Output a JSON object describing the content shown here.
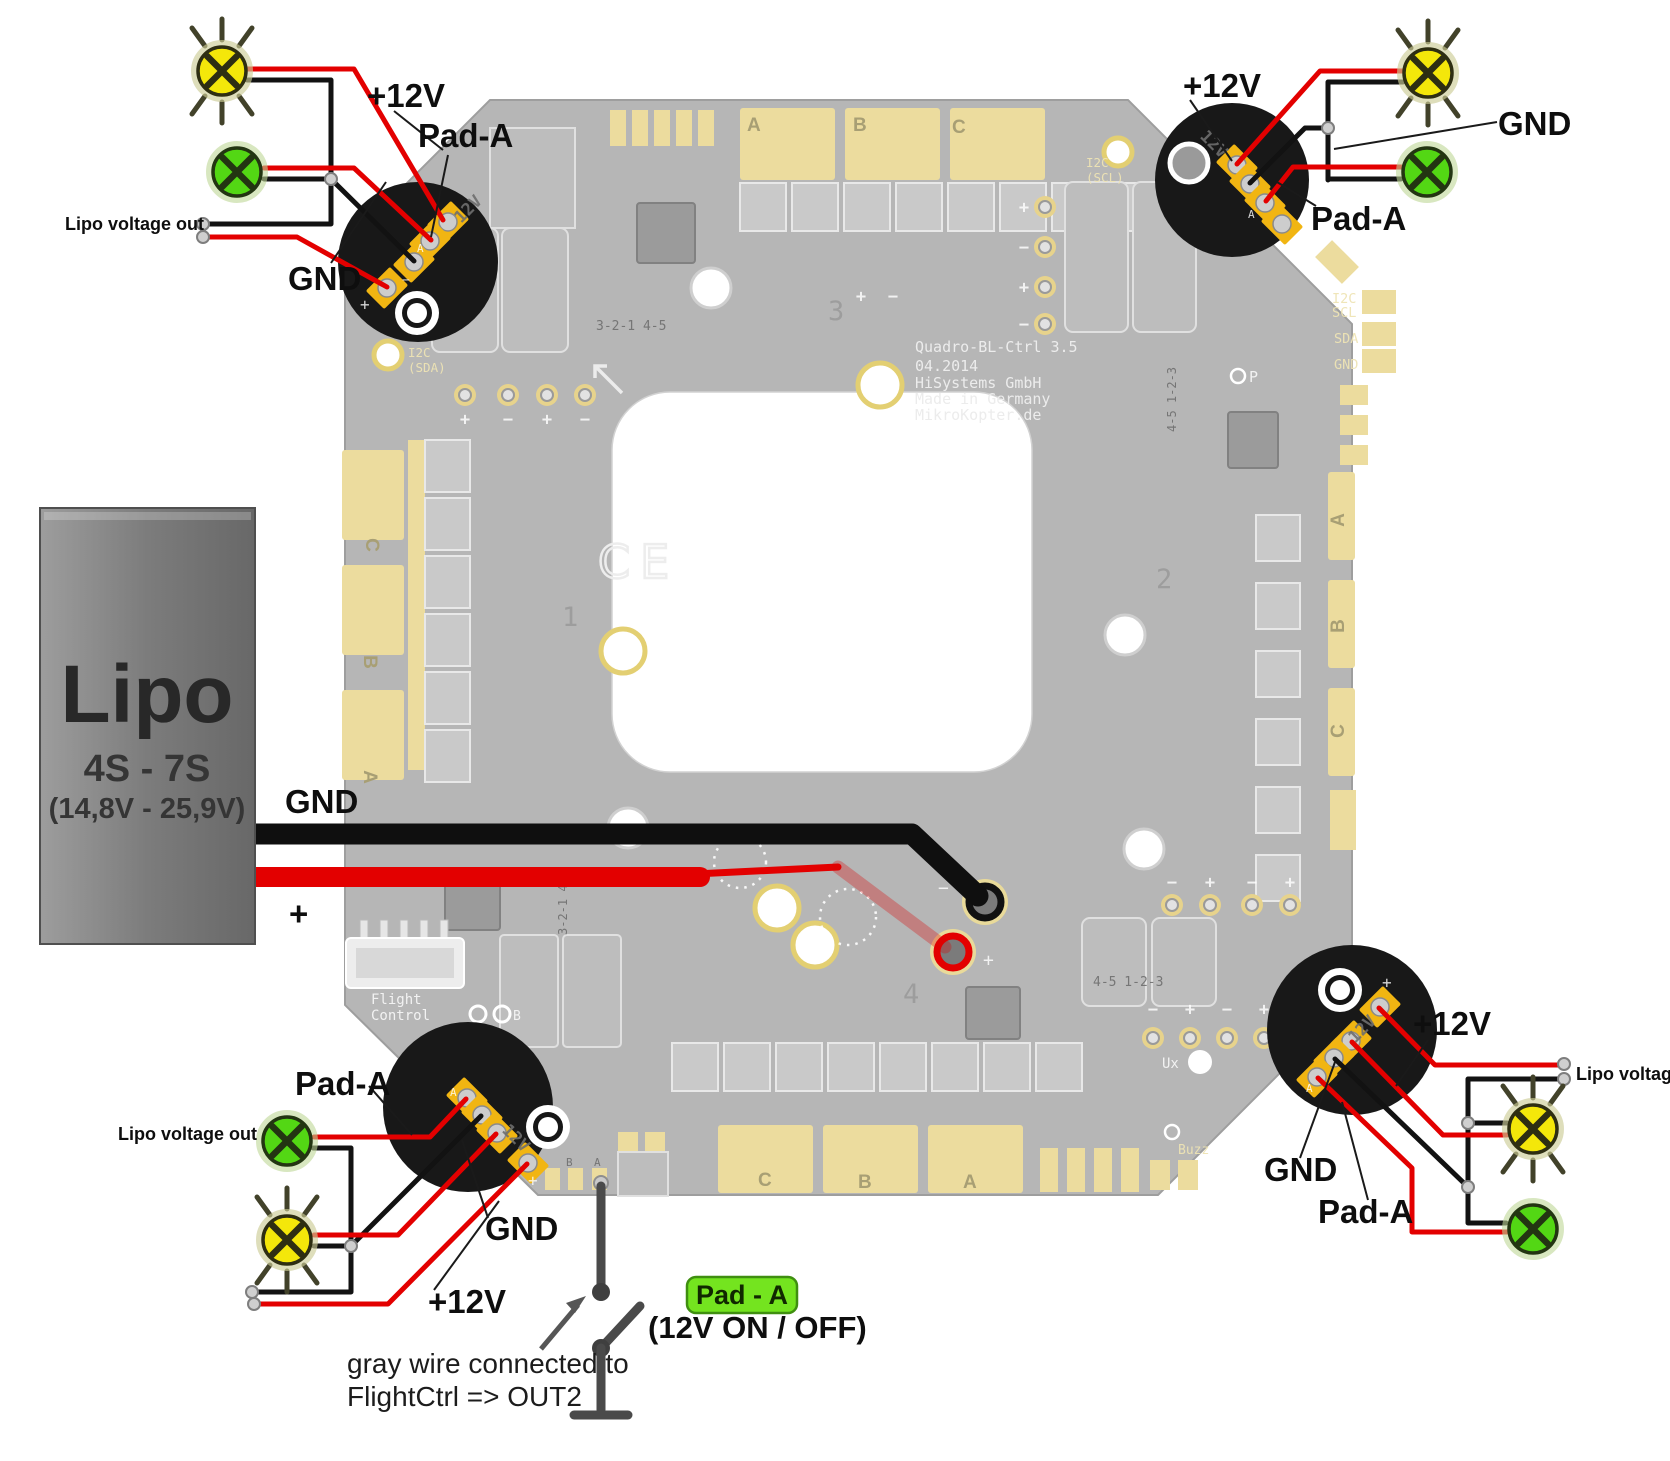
{
  "colors": {
    "wire_red": "#e30000",
    "wire_black": "#121212",
    "led_yellow": "#f4e70a",
    "led_green": "#53d714",
    "badge_green": "#74e41f",
    "board_gray": "#b6b6b6",
    "pad_yellow": "#ecdc9e",
    "module_pad_yellow": "#f1b512"
  },
  "board": {
    "title": "Quadro-BL-Ctrl 3.5",
    "version_date": "04.2014",
    "manufacturer": "HiSystems GmbH",
    "made_in": "Made in Germany",
    "website": "MikroKopter.de",
    "ce_mark": "CE",
    "i2c_label": "I2C",
    "scl_label": "SCL",
    "sda_label": "SDA",
    "gnd_label": "GND",
    "scl_paren": "(SCL)",
    "sda_paren": "(SDA)",
    "motor_1": "1",
    "motor_2": "2",
    "motor_3": "3",
    "motor_4": "4",
    "conn_row_1": "3-2-1 4-5",
    "conn_row_2": "4-5 1-2-3",
    "flight_label": "Flight",
    "control_label": "Control",
    "buzz_label": "Buzz",
    "ux_label": "Ux",
    "p_label": "P",
    "b_label": "B",
    "a_label": "A",
    "module_12v": "12V",
    "plus_mark": "+",
    "minus_mark": "−",
    "phase_top": [
      "A",
      "B",
      "C"
    ],
    "phase_bottom": [
      "C",
      "B",
      "A"
    ],
    "phase_left": [
      "C",
      "B",
      "A"
    ],
    "phase_right": [
      "A",
      "B",
      "C"
    ]
  },
  "lipo": {
    "title": "Lipo",
    "cells": "4S - 7S",
    "voltage_range": "(14,8V - 25,9V)",
    "gnd_label": "GND",
    "plus_label": "+"
  },
  "corners": {
    "top_left": {
      "v12": "+12V",
      "pad_a": "Pad-A",
      "lipo_out": "Lipo voltage out",
      "gnd": "GND"
    },
    "top_right": {
      "v12": "+12V",
      "gnd": "GND",
      "pad_a": "Pad-A"
    },
    "bottom_left": {
      "pad_a": "Pad-A",
      "lipo_out": "Lipo voltage out",
      "gnd": "GND",
      "v12": "+12V"
    },
    "bottom_right": {
      "v12": "+12V",
      "lipo_voltage": "Lipo voltage",
      "gnd": "GND",
      "pad_a": "Pad-A"
    }
  },
  "switch": {
    "badge": "Pad - A",
    "mode": "(12V ON / OFF)",
    "note_line1": "gray wire connected to",
    "note_line2": "FlightCtrl => OUT2"
  }
}
